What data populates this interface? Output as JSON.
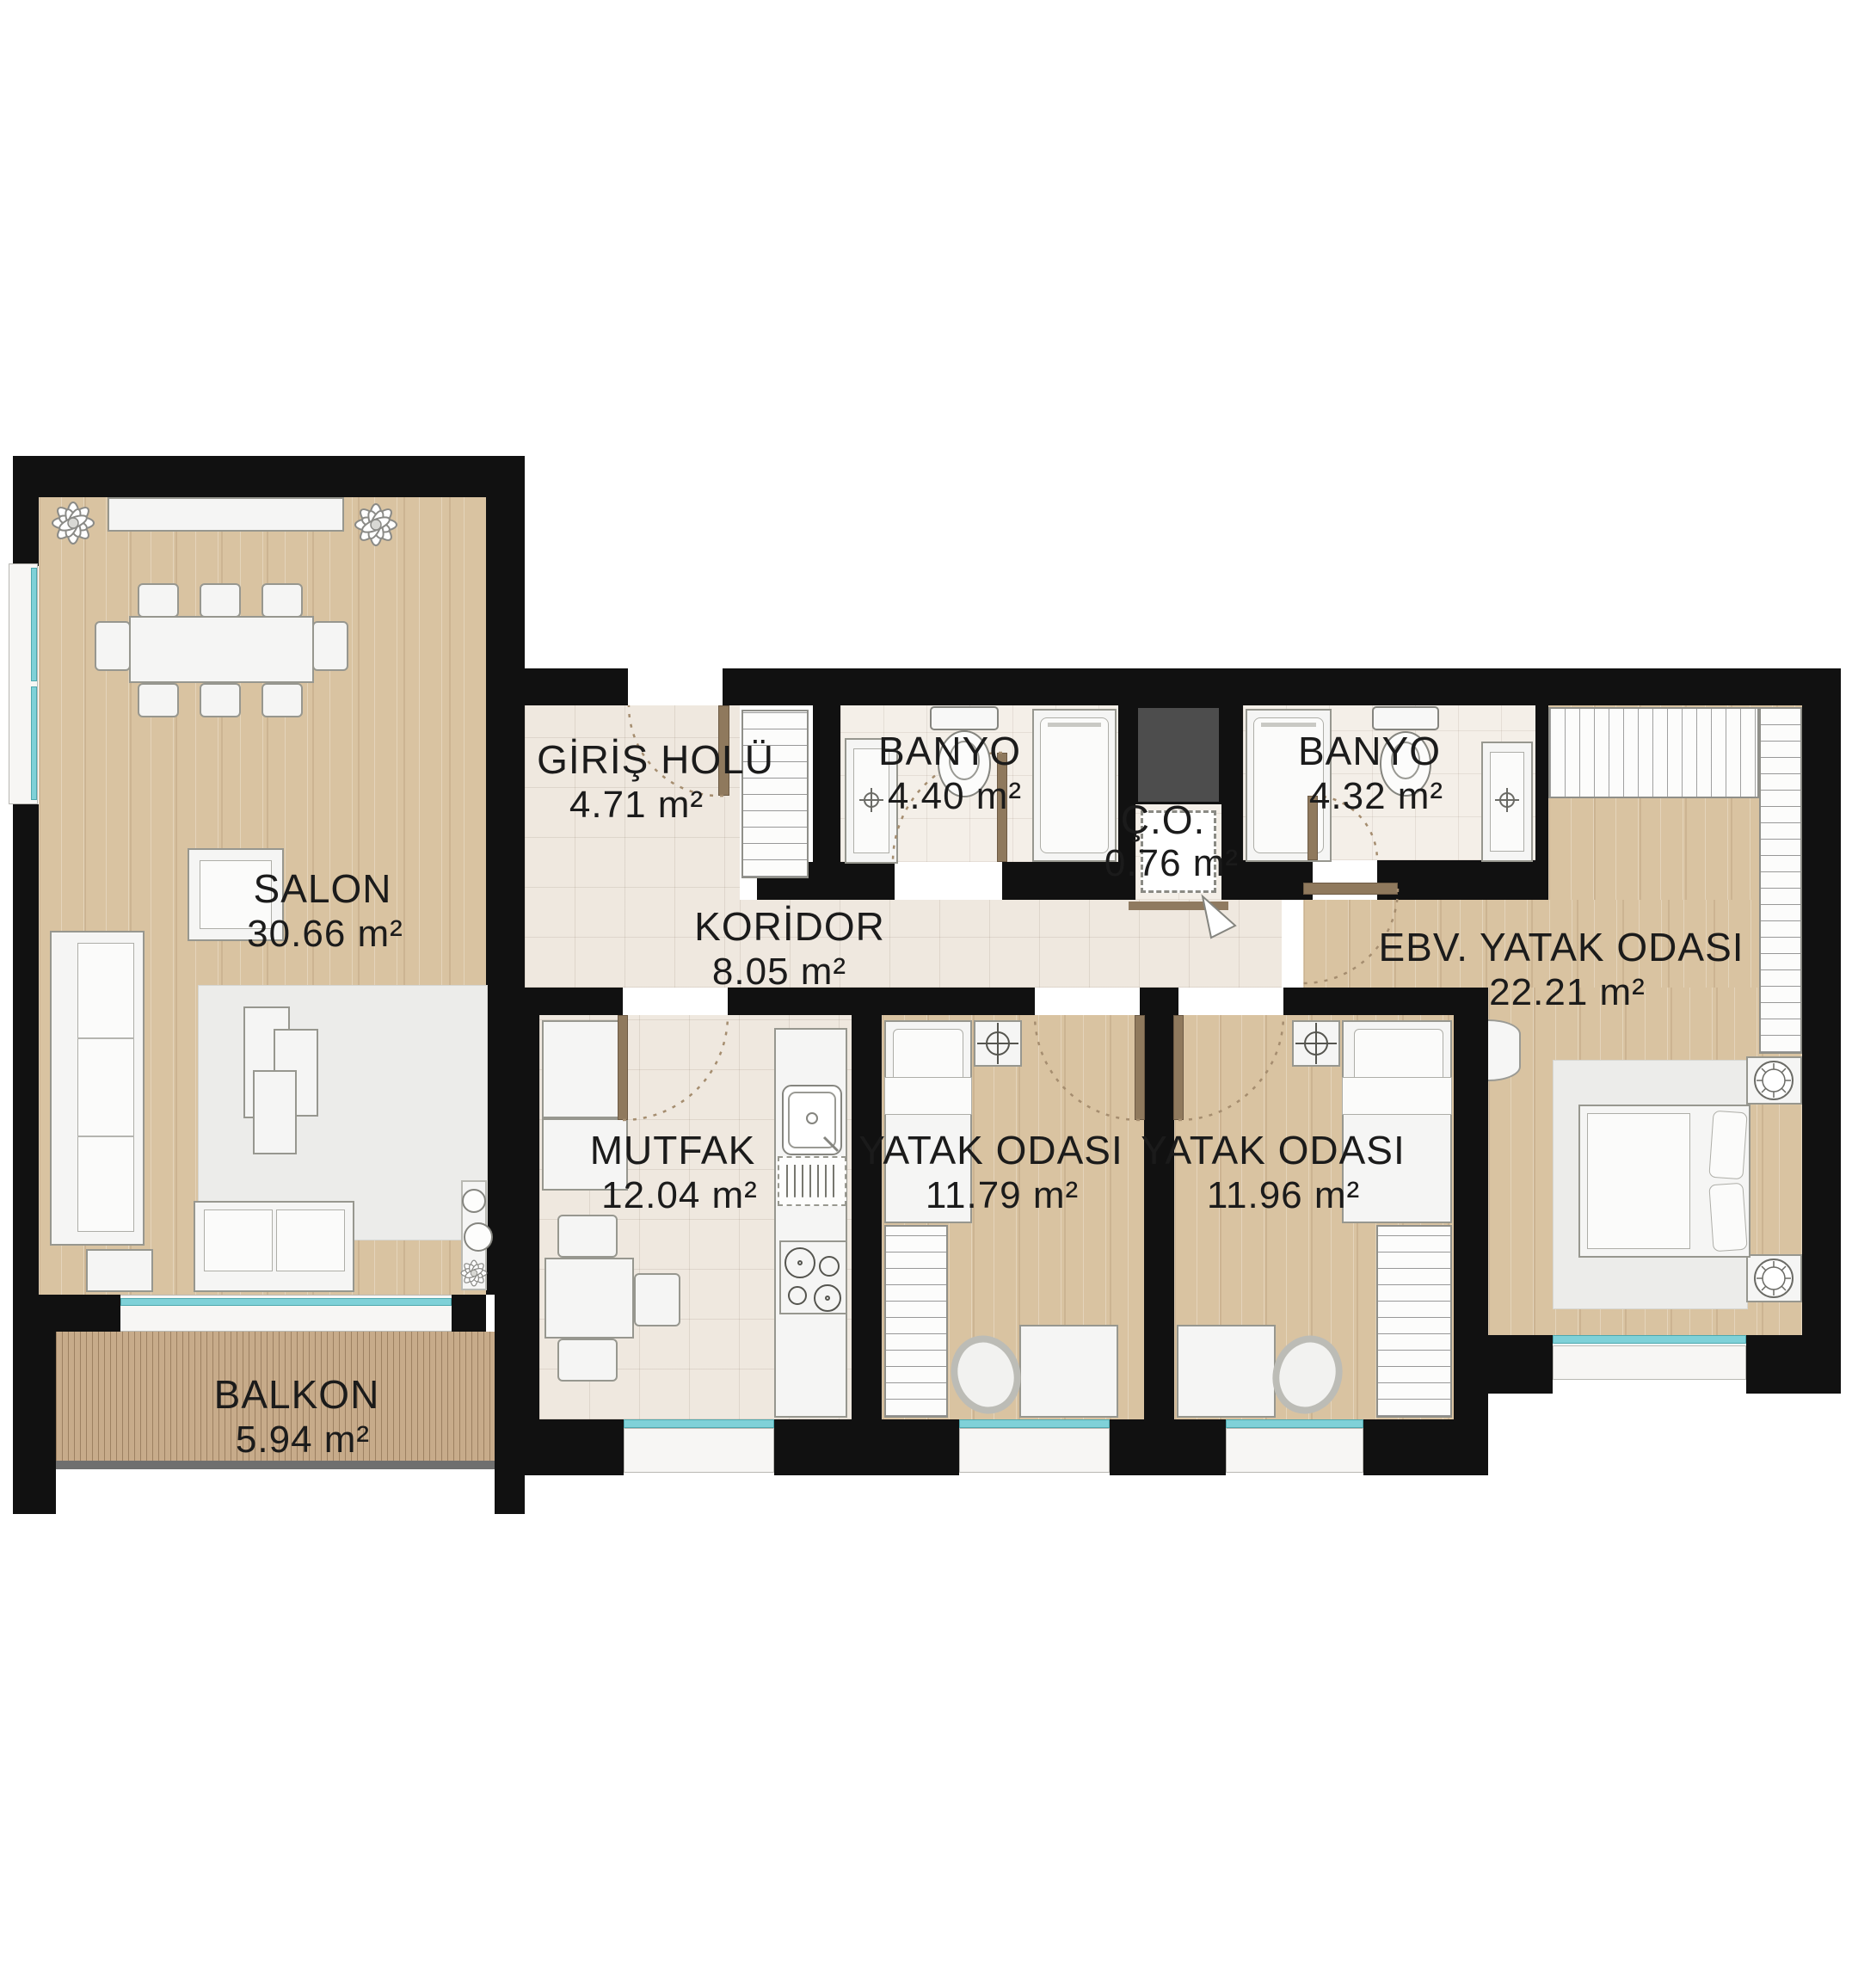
{
  "plan_type": "apartment-floor-plan",
  "rooms": [
    {
      "id": "salon",
      "name": "SALON",
      "area": "30.66 m²"
    },
    {
      "id": "giris_holu",
      "name": "GİRİŞ HOLÜ",
      "area": "4.71 m²"
    },
    {
      "id": "banyo_1",
      "name": "BANYO",
      "area": "4.40 m²"
    },
    {
      "id": "co",
      "name": "Ç.O.",
      "area": "0.76 m²"
    },
    {
      "id": "banyo_2",
      "name": "BANYO",
      "area": "4.32 m²"
    },
    {
      "id": "koridor",
      "name": "KORİDOR",
      "area": "8.05 m²"
    },
    {
      "id": "ebv_yatak_odasi",
      "name": "EBV. YATAK ODASI",
      "area": "22.21 m²"
    },
    {
      "id": "mutfak",
      "name": "MUTFAK",
      "area": "12.04 m²"
    },
    {
      "id": "yatak_odasi_1",
      "name": "YATAK ODASI",
      "area": "11.79 m²"
    },
    {
      "id": "yatak_odasi_2",
      "name": "YATAK ODASI",
      "area": "11.96 m²"
    },
    {
      "id": "balkon",
      "name": "BALKON",
      "area": "5.94 m²"
    }
  ],
  "colors": {
    "wall": "#111111",
    "wood_floor": "#d9c3a1",
    "balcony_deck": "#c7ab8a",
    "tile_floor": "#efe8df",
    "bath_tile": "#f4efe8",
    "shaft": "#4d4d4d",
    "window": "#7fd1d8",
    "door": "#8f795d",
    "label": "#1b1b1b"
  }
}
